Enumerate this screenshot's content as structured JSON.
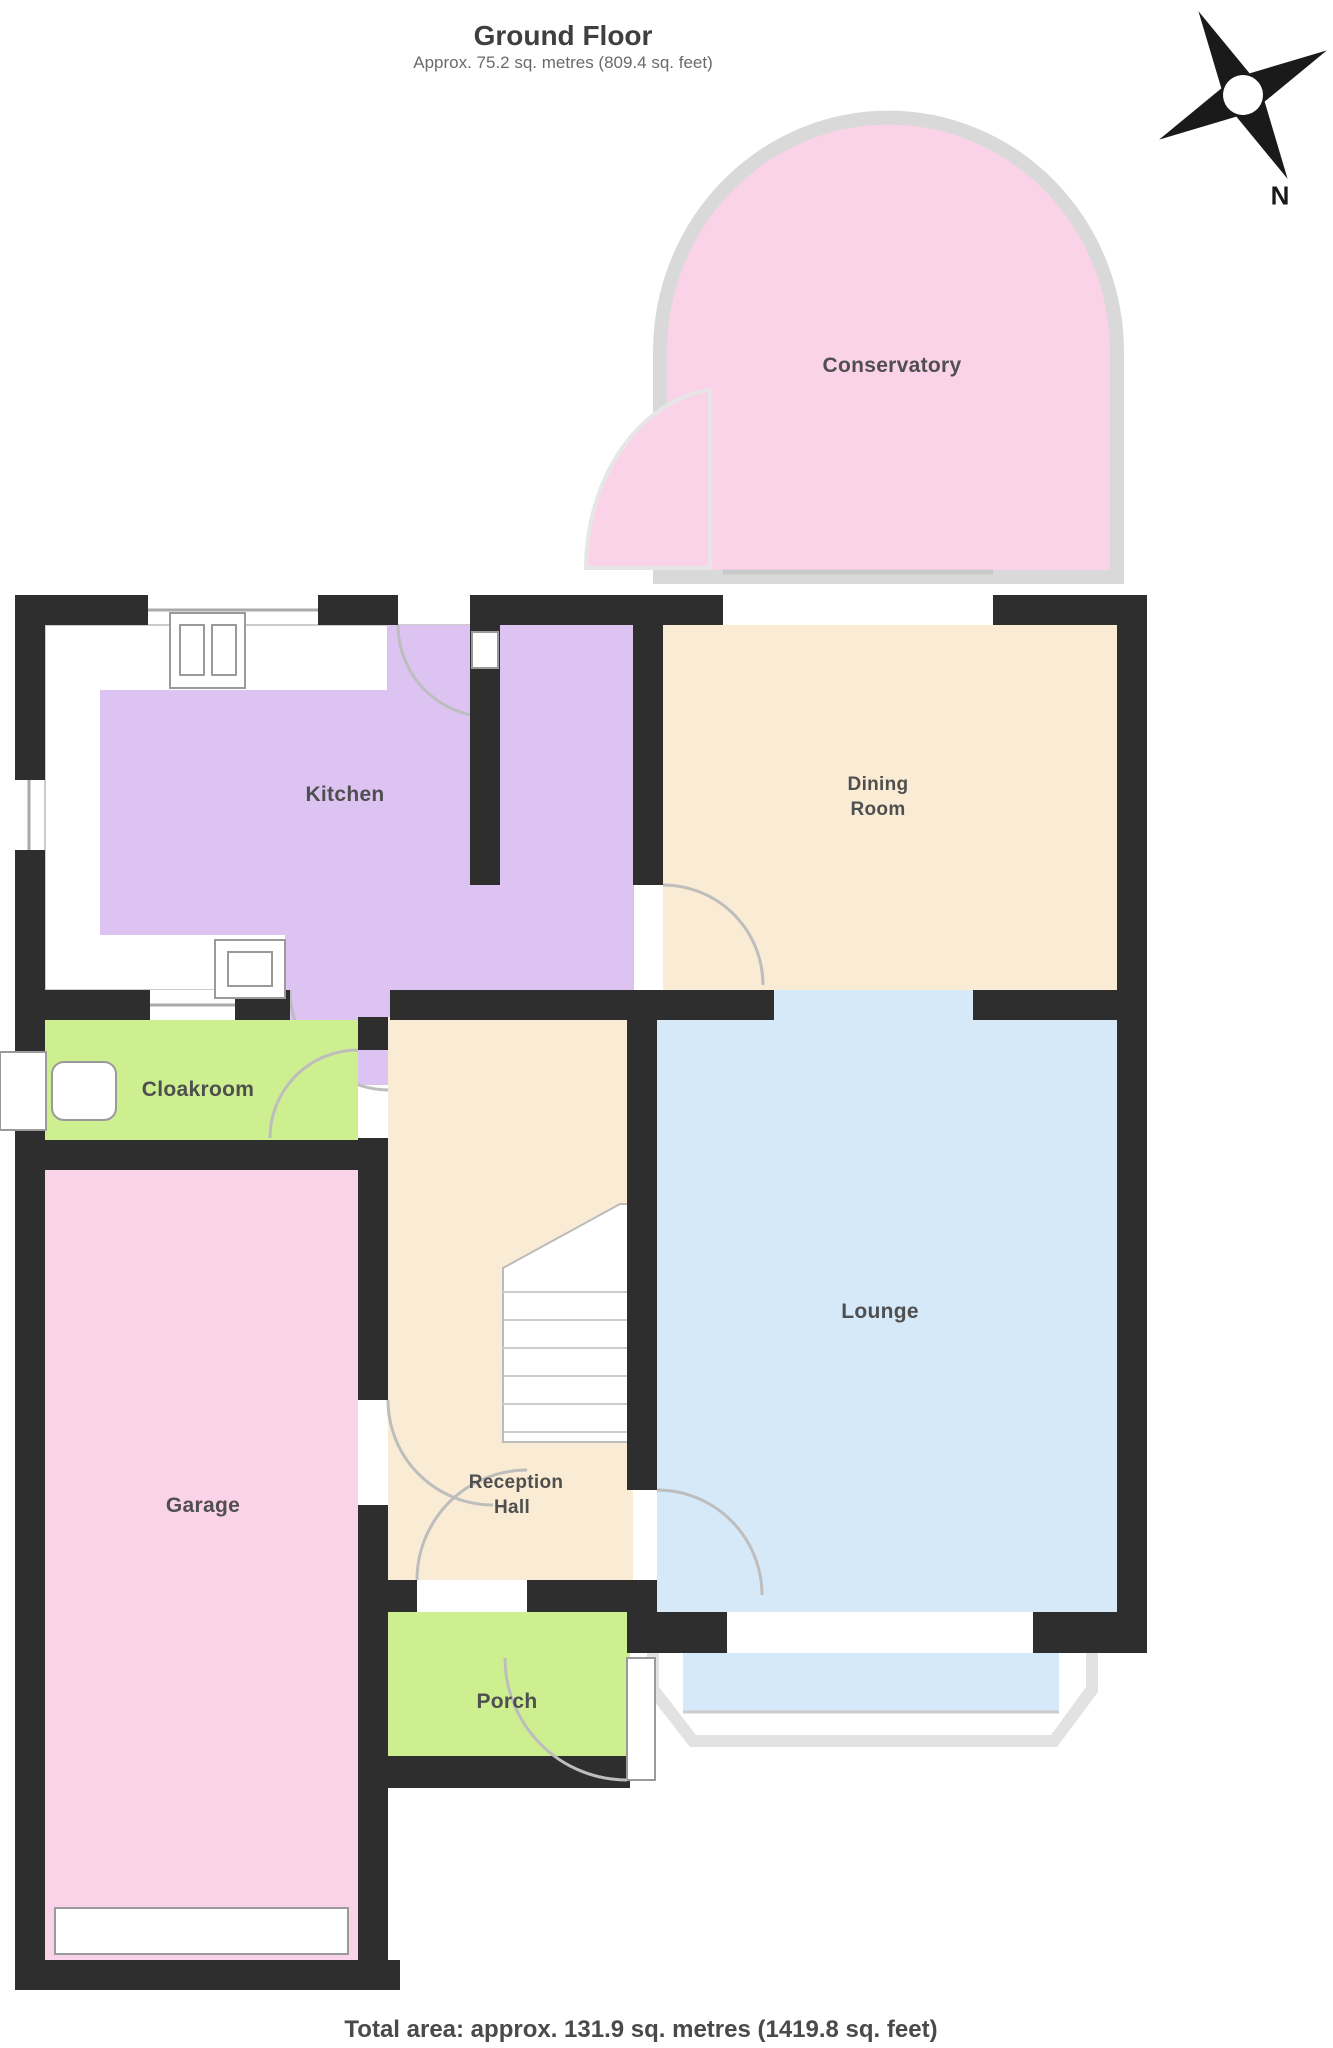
{
  "header": {
    "title": "Ground Floor",
    "subtitle": "Approx. 75.2 sq. metres (809.4 sq. feet)"
  },
  "compass": {
    "north_label": "N"
  },
  "rooms": {
    "conservatory": {
      "label": "Conservatory"
    },
    "kitchen": {
      "label": "Kitchen"
    },
    "dining": {
      "label_line1": "Dining",
      "label_line2": "Room"
    },
    "lounge": {
      "label": "Lounge"
    },
    "cloakroom": {
      "label": "Cloakroom"
    },
    "garage": {
      "label": "Garage"
    },
    "reception_hall": {
      "label_line1": "Reception",
      "label_line2": "Hall"
    },
    "porch": {
      "label": "Porch"
    }
  },
  "footer": {
    "total_area": "Total area: approx. 131.9 sq. metres (1419.8 sq. feet)"
  },
  "colors": {
    "wall": "#2e2e2e",
    "conservatory_fill": "#fbd3e8",
    "garage_fill": "#fbd3e8",
    "kitchen_fill": "#ddc3f2",
    "dining_fill": "#faecd4",
    "hall_fill": "#faecd4",
    "lounge_fill": "#d6e9f9",
    "cloakroom_fill": "#cdef90",
    "porch_fill": "#cdef90",
    "glazing_outline": "#dcdcdc"
  }
}
